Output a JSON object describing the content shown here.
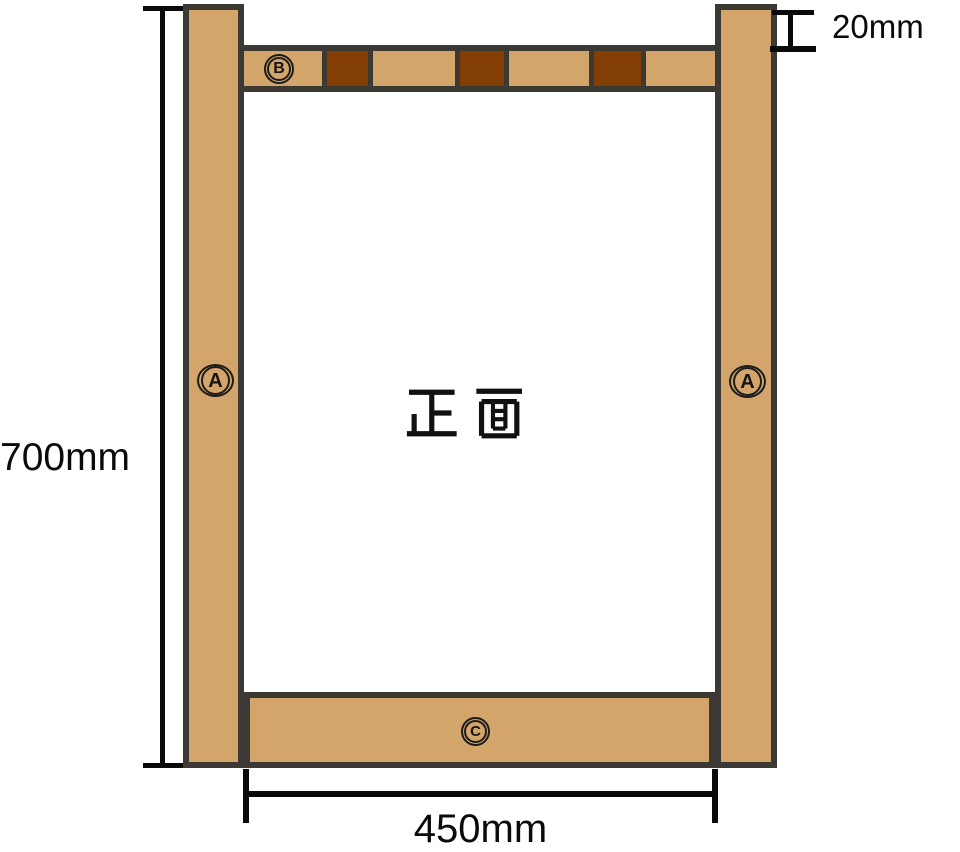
{
  "diagram": {
    "view_label": "正面",
    "part_labels": {
      "post": "A",
      "top_rail": "B",
      "bottom_rail": "C"
    },
    "dimensions": {
      "height": "700mm",
      "width": "450mm",
      "top_rail_offset": "20mm"
    },
    "top_rail_segments": [
      "wood_light",
      "wood_dark",
      "wood_light",
      "wood_dark",
      "wood_light",
      "wood_dark",
      "wood_light"
    ],
    "colors": {
      "wood_light": "#D3A56A",
      "wood_dark": "#833F03",
      "outline": "#3C3833",
      "dimension_line": "#000000"
    }
  }
}
